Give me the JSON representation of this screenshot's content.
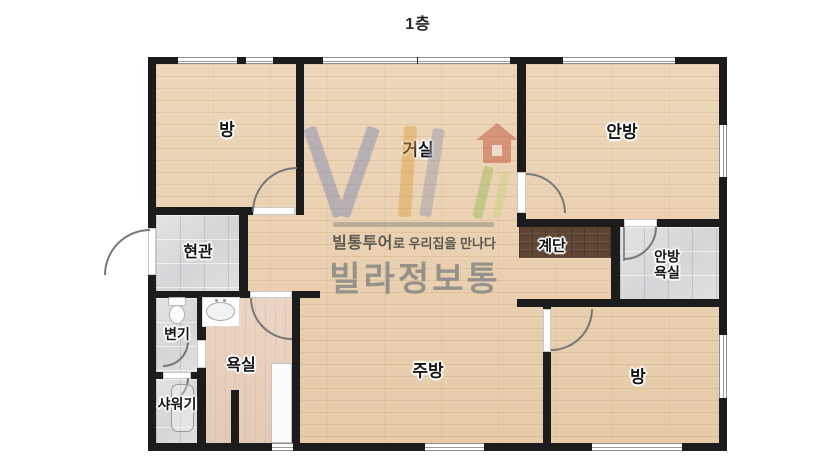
{
  "title": "1층",
  "colors": {
    "wall": "#1c1c1c",
    "wood_floor": "#e9d2b2",
    "tile_floor": "#dcdcde",
    "bath_floor": "#e7cfbd",
    "stairs": "#5e4533",
    "door_arc": "#777777",
    "label_text": "#151515",
    "watermark_v": "#8289b4",
    "watermark_i": "#dd9f47",
    "watermark_l": "#9b9bad",
    "watermark_green": "#9fba5e",
    "watermark_house": "#bf4f38",
    "brand_text": "#8b8a86"
  },
  "watermark": {
    "logo_letters": "VIL",
    "house_icon": "house-icon",
    "tagline_bold": "빌통투어",
    "tagline_rest": "로 우리집을 만나다",
    "brand": "빌라정보통"
  },
  "plan": {
    "floors": [
      {
        "type": "wood",
        "name": "floor-open-area",
        "x": 156,
        "y": 64,
        "w": 563,
        "h": 379
      },
      {
        "type": "tile",
        "name": "floor-entrance",
        "x": 156,
        "y": 215,
        "w": 83,
        "h": 76
      },
      {
        "type": "tile",
        "name": "floor-toilet",
        "x": 156,
        "y": 298,
        "w": 41,
        "h": 74
      },
      {
        "type": "tile",
        "name": "floor-shower",
        "x": 156,
        "y": 379,
        "w": 41,
        "h": 64
      },
      {
        "type": "bath",
        "name": "floor-bathroom",
        "x": 205,
        "y": 298,
        "w": 87,
        "h": 145
      },
      {
        "type": "tile",
        "name": "floor-master-bath",
        "x": 620,
        "y": 227,
        "w": 99,
        "h": 72
      },
      {
        "type": "stairs",
        "name": "floor-stairs",
        "x": 519,
        "y": 227,
        "w": 92,
        "h": 31
      }
    ],
    "walls": [
      [
        148,
        57,
        579,
        7
      ],
      [
        148,
        57,
        8,
        394
      ],
      [
        719,
        57,
        8,
        394
      ],
      [
        148,
        443,
        579,
        8
      ],
      [
        296,
        57,
        8,
        158
      ],
      [
        148,
        207,
        107,
        8
      ],
      [
        239,
        212,
        9,
        86
      ],
      [
        148,
        291,
        104,
        7
      ],
      [
        292,
        291,
        28,
        7
      ],
      [
        197,
        298,
        9,
        153
      ],
      [
        148,
        372,
        58,
        7
      ],
      [
        292,
        298,
        8,
        153
      ],
      [
        231,
        390,
        8,
        61
      ],
      [
        517,
        57,
        9,
        163
      ],
      [
        517,
        219,
        210,
        8
      ],
      [
        611,
        227,
        9,
        79
      ],
      [
        517,
        299,
        210,
        8
      ],
      [
        543,
        307,
        8,
        144
      ]
    ],
    "windows": [
      {
        "x": 178,
        "y": 57,
        "w": 59,
        "h": 7,
        "dir": "h"
      },
      {
        "x": 246,
        "y": 57,
        "w": 27,
        "h": 7,
        "dir": "h"
      },
      {
        "x": 323,
        "y": 57,
        "w": 94,
        "h": 7,
        "dir": "h"
      },
      {
        "x": 418,
        "y": 57,
        "w": 92,
        "h": 7,
        "dir": "h"
      },
      {
        "x": 563,
        "y": 57,
        "w": 112,
        "h": 7,
        "dir": "h"
      },
      {
        "x": 719,
        "y": 125,
        "w": 8,
        "h": 52,
        "dir": "v"
      },
      {
        "x": 719,
        "y": 335,
        "w": 8,
        "h": 63,
        "dir": "v"
      },
      {
        "x": 272,
        "y": 443,
        "w": 21,
        "h": 8,
        "dir": "h"
      },
      {
        "x": 425,
        "y": 443,
        "w": 59,
        "h": 8,
        "dir": "h"
      },
      {
        "x": 592,
        "y": 443,
        "w": 90,
        "h": 8,
        "dir": "h"
      }
    ],
    "door_leaves": [
      [
        253,
        207,
        42,
        8
      ],
      [
        148,
        228,
        8,
        47
      ],
      [
        250,
        291,
        42,
        7
      ],
      [
        197,
        340,
        9,
        28
      ],
      [
        163,
        372,
        28,
        7
      ],
      [
        517,
        172,
        9,
        41
      ],
      [
        624,
        219,
        33,
        8
      ],
      [
        543,
        309,
        8,
        43
      ]
    ],
    "door_lines": [
      [
        623,
        227,
        2,
        34
      ]
    ],
    "door_arcs": [
      {
        "x": 252,
        "y": 167,
        "w": 45,
        "h": 45,
        "corner": "tl"
      },
      {
        "x": 104,
        "y": 229,
        "w": 46,
        "h": 46,
        "corner": "tl"
      },
      {
        "x": 250,
        "y": 298,
        "w": 42,
        "h": 42,
        "corner": "bl"
      },
      {
        "x": 163,
        "y": 341,
        "w": 26,
        "h": 26,
        "corner": "br"
      },
      {
        "x": 163,
        "y": 378,
        "w": 26,
        "h": 26,
        "corner": "br"
      },
      {
        "x": 526,
        "y": 173,
        "w": 40,
        "h": 40,
        "corner": "tr"
      },
      {
        "x": 624,
        "y": 227,
        "w": 33,
        "h": 33,
        "corner": "br"
      },
      {
        "x": 551,
        "y": 309,
        "w": 42,
        "h": 42,
        "corner": "br"
      }
    ],
    "fixtures": [
      {
        "type": "toilet",
        "icon": "toilet-icon",
        "x": 167,
        "y": 297,
        "w": 20,
        "h": 28
      },
      {
        "type": "sink",
        "icon": "sink-icon",
        "x": 202,
        "y": 297,
        "w": 38,
        "h": 30
      },
      {
        "type": "shower",
        "icon": "shower-tray-icon",
        "x": 171,
        "y": 384,
        "w": 23,
        "h": 48
      },
      {
        "type": "tub",
        "icon": "bathtub-icon",
        "x": 271,
        "y": 363,
        "w": 21,
        "h": 80
      }
    ],
    "rooms": [
      {
        "id": "room-bang-top",
        "lines": [
          "방"
        ],
        "cx": 227,
        "cy": 130,
        "fs": 17
      },
      {
        "id": "room-geosil",
        "lines": [
          "거실"
        ],
        "cx": 418,
        "cy": 150,
        "fs": 17
      },
      {
        "id": "room-anbang",
        "lines": [
          "안방"
        ],
        "cx": 622,
        "cy": 132,
        "fs": 17
      },
      {
        "id": "room-hyeongwan",
        "lines": [
          "현관"
        ],
        "cx": 198,
        "cy": 253,
        "fs": 16
      },
      {
        "id": "room-gyedan",
        "lines": [
          "계단"
        ],
        "cx": 552,
        "cy": 247,
        "fs": 15
      },
      {
        "id": "room-anbang-yoksil",
        "lines": [
          "안방",
          "욕실"
        ],
        "cx": 667,
        "cy": 265,
        "fs": 14
      },
      {
        "id": "room-byeongi",
        "lines": [
          "변기"
        ],
        "cx": 177,
        "cy": 335,
        "fs": 14
      },
      {
        "id": "room-yoksil",
        "lines": [
          "욕실"
        ],
        "cx": 241,
        "cy": 366,
        "fs": 16
      },
      {
        "id": "room-syawogi",
        "lines": [
          "샤워기"
        ],
        "cx": 177,
        "cy": 405,
        "fs": 14
      },
      {
        "id": "room-jubang",
        "lines": [
          "주방"
        ],
        "cx": 428,
        "cy": 371,
        "fs": 17
      },
      {
        "id": "room-bang-bottom",
        "lines": [
          "방"
        ],
        "cx": 638,
        "cy": 377,
        "fs": 17
      }
    ]
  }
}
